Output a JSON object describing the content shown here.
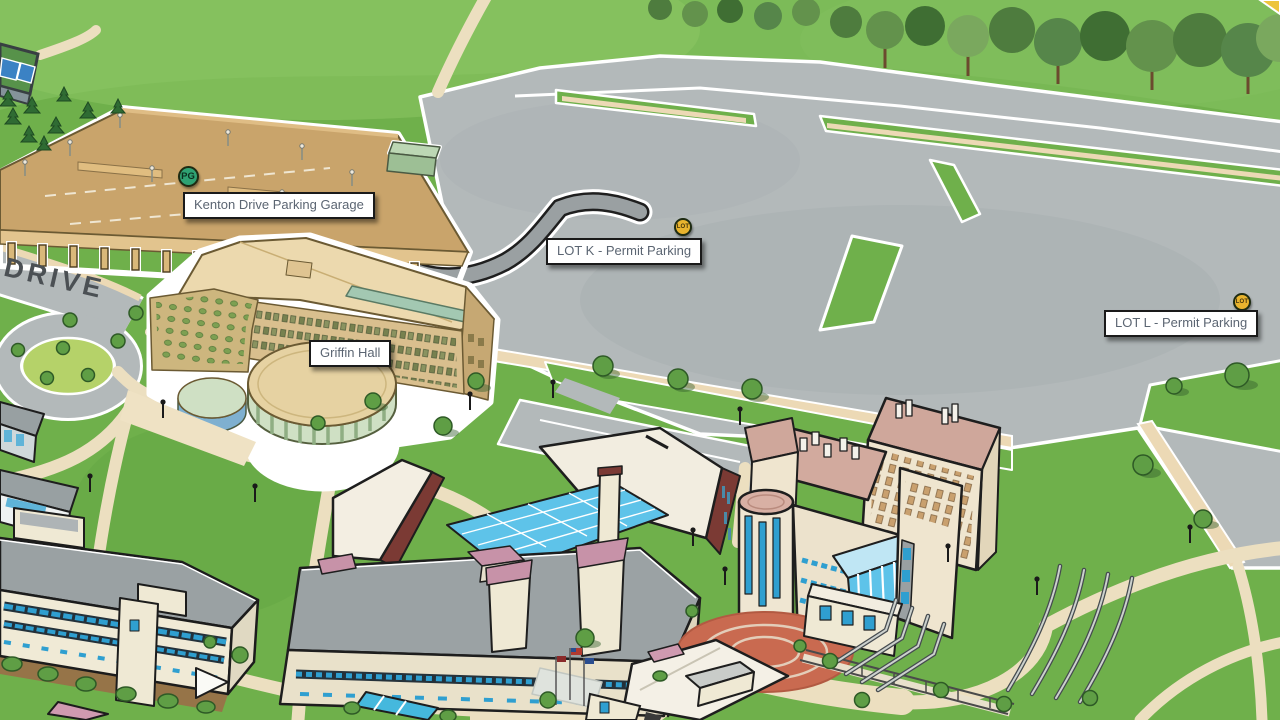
{
  "map": {
    "road_label": "DRIVE",
    "label_style": {
      "background": "#ffffff",
      "border": "#1a1a1a",
      "text": "#5b6572"
    },
    "markers": [
      {
        "id": "kenton-drive-parking-garage",
        "kind": "parking-garage",
        "icon_text": "PG",
        "icon_color": "#2fa273",
        "label": "Kenton Drive Parking Garage",
        "icon": {
          "cx": 188,
          "cy": 176
        },
        "box": {
          "x": 183,
          "y": 192
        }
      },
      {
        "id": "lot-k",
        "kind": "parking-lot",
        "icon_text": "LOT",
        "icon_color": "#e9b42e",
        "label": "LOT K - Permit Parking",
        "icon": {
          "cx": 683,
          "cy": 227
        },
        "box": {
          "x": 546,
          "y": 238
        }
      },
      {
        "id": "lot-l",
        "kind": "parking-lot",
        "icon_text": "LOT",
        "icon_color": "#e9b42e",
        "label": "LOT L - Permit Parking",
        "icon": {
          "cx": 1242,
          "cy": 302
        },
        "box": {
          "x": 1104,
          "y": 310
        }
      },
      {
        "id": "griffin-hall",
        "kind": "building",
        "icon_text": null,
        "icon_color": null,
        "label": "Griffin Hall",
        "icon": null,
        "box": {
          "x": 309,
          "y": 340
        }
      }
    ]
  }
}
